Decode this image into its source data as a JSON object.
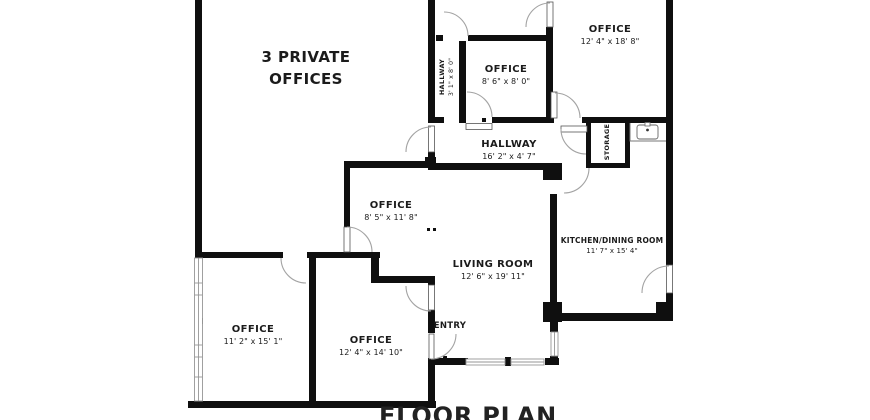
{
  "plan": {
    "title": "FLOOR PLAN",
    "callout": {
      "line1": "3 PRIVATE",
      "line2": "OFFICES"
    },
    "rooms": {
      "top_room": {
        "dims": "11' 11\" x 10' 1\""
      },
      "office_top_right": {
        "name": "OFFICE",
        "dims": "12' 4\" x 18' 8\""
      },
      "office_center_top": {
        "name": "OFFICE",
        "dims": "8' 6\" x 8' 0\""
      },
      "hallway_vertical": {
        "name": "HALLWAY",
        "dims": "3' 1\" x 8' 0\""
      },
      "hallway_main": {
        "name": "HALLWAY",
        "dims": "16' 2\" x 4' 7\""
      },
      "storage": {
        "name": "STORAGE"
      },
      "office_middle": {
        "name": "OFFICE",
        "dims": "8' 5\" x 11' 8\""
      },
      "living_room": {
        "name": "LIVING ROOM",
        "dims": "12' 6\" x 19' 11\""
      },
      "kitchen_dining": {
        "name": "KITCHEN/DINING ROOM",
        "dims": "11' 7\" x 15' 4\""
      },
      "entry": {
        "name": "ENTRY"
      },
      "office_bottom_left": {
        "name": "OFFICE",
        "dims": "11' 2\" x 15' 1\""
      },
      "office_bottom_mid": {
        "name": "OFFICE",
        "dims": "12' 4\" x 14' 10\""
      }
    },
    "fixtures": {
      "sink": "kitchen-sink"
    },
    "colors": {
      "wall": "#0f0f0f",
      "door_arc": "#a3a3a3",
      "window_line": "#969696",
      "text": "#1b1b1b",
      "background": "#ffffff"
    }
  }
}
